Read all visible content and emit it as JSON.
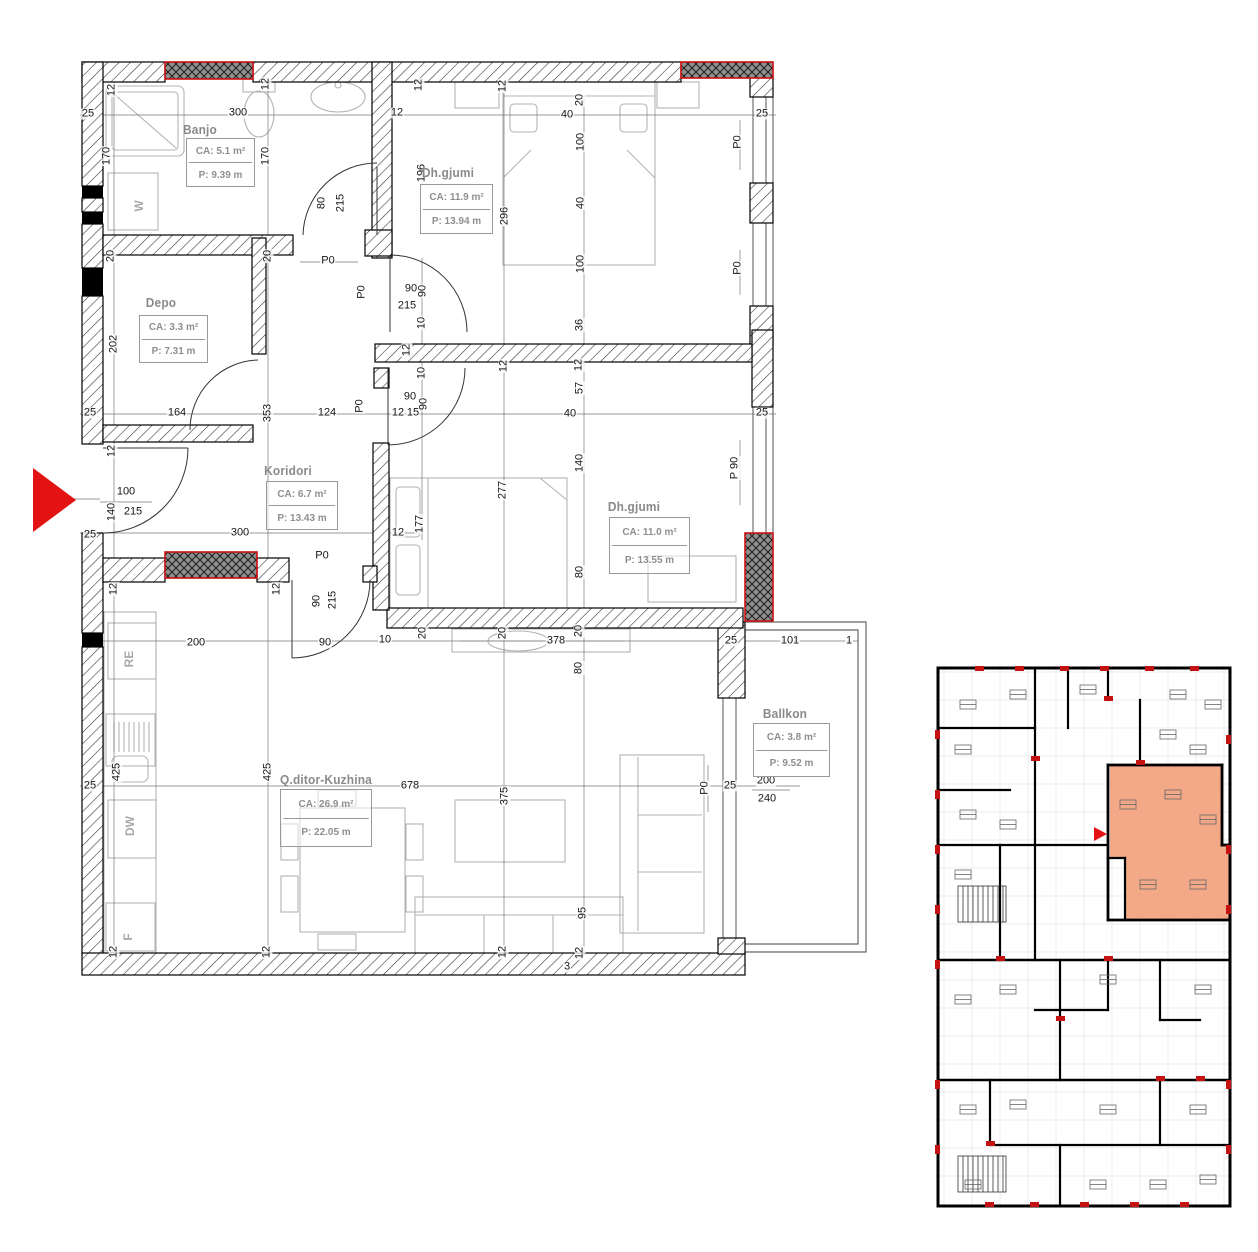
{
  "drawing": {
    "type": "apartment-floor-plan",
    "colors": {
      "wall_line": "#000000",
      "shaft_red": "#cc1111",
      "arrow_red": "#e31313",
      "highlight_orange": "#f2a07b",
      "label_gray": "#8f8f8f",
      "furniture_gray": "#b3b3b3"
    }
  },
  "rooms": [
    {
      "id": "banjo",
      "name": "Banjo",
      "area": "CA:  5.1 m²",
      "perimeter": "P: 9.39 m",
      "name_x": 200,
      "name_y": 130,
      "box_x": 186,
      "box_y": 138,
      "box_w": 67,
      "box_h": 47
    },
    {
      "id": "dhgjumi-1",
      "name": "Dh.gjumi",
      "area": "CA:  11.9 m²",
      "perimeter": "P: 13.94 m",
      "name_x": 448,
      "name_y": 173,
      "box_x": 420,
      "box_y": 184,
      "box_w": 71,
      "box_h": 48
    },
    {
      "id": "depo",
      "name": "Depo",
      "area": "CA: 3.3 m²",
      "perimeter": "P:  7.31 m",
      "name_x": 161,
      "name_y": 303,
      "box_x": 139,
      "box_y": 315,
      "box_w": 67,
      "box_h": 46
    },
    {
      "id": "koridori",
      "name": "Koridori",
      "area": "CA:  6.7 m²",
      "perimeter": "P: 13.43 m",
      "name_x": 288,
      "name_y": 471,
      "box_x": 266,
      "box_y": 481,
      "box_w": 70,
      "box_h": 47
    },
    {
      "id": "dhgjumi-2",
      "name": "Dh.gjumi",
      "area": "CA:  11.0 m²",
      "perimeter": "P: 13.55 m",
      "name_x": 634,
      "name_y": 507,
      "box_x": 609,
      "box_y": 517,
      "box_w": 79,
      "box_h": 55
    },
    {
      "id": "qditor-kuzhina",
      "name": "Q.ditor-Kuzhina",
      "area": "CA:  26.9 m²",
      "perimeter": "P:  22.05 m",
      "name_x": 326,
      "name_y": 780,
      "box_x": 280,
      "box_y": 789,
      "box_w": 90,
      "box_h": 56
    },
    {
      "id": "ballkon",
      "name": "Ballkon",
      "area": "CA: 3.8 m²",
      "perimeter": "P: 9.52 m",
      "name_x": 785,
      "name_y": 714,
      "box_x": 753,
      "box_y": 723,
      "box_w": 75,
      "box_h": 52
    }
  ],
  "appliances": [
    {
      "label": "W",
      "x": 139,
      "y": 206
    },
    {
      "label": "RE",
      "x": 129,
      "y": 659
    },
    {
      "label": "DW",
      "x": 130,
      "y": 826
    },
    {
      "label": "F",
      "x": 128,
      "y": 937
    }
  ],
  "dimensions": [
    {
      "t": "25",
      "x": 88,
      "y": 114,
      "r": 0
    },
    {
      "t": "12",
      "x": 112,
      "y": 90,
      "r": 90
    },
    {
      "t": "170",
      "x": 107,
      "y": 156,
      "r": 90
    },
    {
      "t": "300",
      "x": 238,
      "y": 113,
      "r": 0
    },
    {
      "t": "12",
      "x": 266,
      "y": 84,
      "r": 90
    },
    {
      "t": "170",
      "x": 266,
      "y": 156,
      "r": 90
    },
    {
      "t": "12",
      "x": 397,
      "y": 113,
      "r": 0
    },
    {
      "t": "12",
      "x": 419,
      "y": 85,
      "r": 90
    },
    {
      "t": "12",
      "x": 503,
      "y": 86,
      "r": 90
    },
    {
      "t": "20",
      "x": 580,
      "y": 100,
      "r": 90
    },
    {
      "t": "40",
      "x": 567,
      "y": 115,
      "r": 0
    },
    {
      "t": "100",
      "x": 581,
      "y": 142,
      "r": 90
    },
    {
      "t": "40",
      "x": 581,
      "y": 203,
      "r": 90
    },
    {
      "t": "100",
      "x": 581,
      "y": 264,
      "r": 90
    },
    {
      "t": "36",
      "x": 580,
      "y": 325,
      "r": 90
    },
    {
      "t": "296",
      "x": 505,
      "y": 216,
      "r": 90
    },
    {
      "t": "196",
      "x": 422,
      "y": 173,
      "r": 90
    },
    {
      "t": "25",
      "x": 762,
      "y": 114,
      "r": 0
    },
    {
      "t": "P0",
      "x": 738,
      "y": 142,
      "r": 90
    },
    {
      "t": "P0",
      "x": 738,
      "y": 268,
      "r": 90
    },
    {
      "t": "80",
      "x": 322,
      "y": 203,
      "r": 90
    },
    {
      "t": "215",
      "x": 341,
      "y": 203,
      "r": 90
    },
    {
      "t": "P0",
      "x": 328,
      "y": 261,
      "r": 0
    },
    {
      "t": "20",
      "x": 111,
      "y": 256,
      "r": 90
    },
    {
      "t": "202",
      "x": 114,
      "y": 344,
      "r": 90
    },
    {
      "t": "20",
      "x": 268,
      "y": 256,
      "r": 90
    },
    {
      "t": "25",
      "x": 90,
      "y": 413,
      "r": 0
    },
    {
      "t": "164",
      "x": 177,
      "y": 413,
      "r": 0
    },
    {
      "t": "353",
      "x": 268,
      "y": 413,
      "r": 90
    },
    {
      "t": "124",
      "x": 327,
      "y": 413,
      "r": 0
    },
    {
      "t": "12",
      "x": 112,
      "y": 451,
      "r": 90
    },
    {
      "t": "P0",
      "x": 362,
      "y": 292,
      "r": 90
    },
    {
      "t": "90",
      "x": 411,
      "y": 289,
      "r": 0
    },
    {
      "t": "215",
      "x": 407,
      "y": 306,
      "r": 0
    },
    {
      "t": "90",
      "x": 423,
      "y": 291,
      "r": 90
    },
    {
      "t": "10",
      "x": 422,
      "y": 323,
      "r": 90
    },
    {
      "t": "12",
      "x": 407,
      "y": 350,
      "r": 90
    },
    {
      "t": "10",
      "x": 422,
      "y": 373,
      "r": 90
    },
    {
      "t": "90",
      "x": 410,
      "y": 397,
      "r": 0
    },
    {
      "t": "12",
      "x": 398,
      "y": 413,
      "r": 0
    },
    {
      "t": "15",
      "x": 413,
      "y": 413,
      "r": 0
    },
    {
      "t": "90",
      "x": 424,
      "y": 404,
      "r": 90
    },
    {
      "t": "P0",
      "x": 360,
      "y": 406,
      "r": 90
    },
    {
      "t": "100",
      "x": 126,
      "y": 492,
      "r": 0
    },
    {
      "t": "140",
      "x": 112,
      "y": 512,
      "r": 90
    },
    {
      "t": "215",
      "x": 133,
      "y": 512,
      "r": 0
    },
    {
      "t": "25",
      "x": 90,
      "y": 535,
      "r": 0
    },
    {
      "t": "300",
      "x": 240,
      "y": 533,
      "r": 0
    },
    {
      "t": "12",
      "x": 398,
      "y": 533,
      "r": 0
    },
    {
      "t": "177",
      "x": 420,
      "y": 524,
      "r": 90
    },
    {
      "t": "277",
      "x": 503,
      "y": 490,
      "r": 90
    },
    {
      "t": "12",
      "x": 504,
      "y": 366,
      "r": 90
    },
    {
      "t": "12",
      "x": 579,
      "y": 365,
      "r": 90
    },
    {
      "t": "57",
      "x": 580,
      "y": 388,
      "r": 90
    },
    {
      "t": "40",
      "x": 570,
      "y": 414,
      "r": 0
    },
    {
      "t": "25",
      "x": 762,
      "y": 413,
      "r": 0
    },
    {
      "t": "140",
      "x": 580,
      "y": 463,
      "r": 90
    },
    {
      "t": "80",
      "x": 580,
      "y": 572,
      "r": 90
    },
    {
      "t": "P 90",
      "x": 735,
      "y": 468,
      "r": 90
    },
    {
      "t": "P0",
      "x": 322,
      "y": 556,
      "r": 0
    },
    {
      "t": "90",
      "x": 317,
      "y": 601,
      "r": 90
    },
    {
      "t": "215",
      "x": 333,
      "y": 600,
      "r": 90
    },
    {
      "t": "12",
      "x": 114,
      "y": 589,
      "r": 90
    },
    {
      "t": "12",
      "x": 277,
      "y": 589,
      "r": 90
    },
    {
      "t": "90",
      "x": 325,
      "y": 643,
      "r": 0
    },
    {
      "t": "10",
      "x": 385,
      "y": 640,
      "r": 0
    },
    {
      "t": "20",
      "x": 423,
      "y": 633,
      "r": 90
    },
    {
      "t": "20",
      "x": 503,
      "y": 633,
      "r": 90
    },
    {
      "t": "378",
      "x": 556,
      "y": 641,
      "r": 0
    },
    {
      "t": "20",
      "x": 579,
      "y": 631,
      "r": 90
    },
    {
      "t": "80",
      "x": 579,
      "y": 668,
      "r": 90
    },
    {
      "t": "25",
      "x": 731,
      "y": 641,
      "r": 0
    },
    {
      "t": "101",
      "x": 790,
      "y": 641,
      "r": 0
    },
    {
      "t": "1",
      "x": 849,
      "y": 641,
      "r": 0
    },
    {
      "t": "200",
      "x": 196,
      "y": 643,
      "r": 0
    },
    {
      "t": "425",
      "x": 117,
      "y": 772,
      "r": 90
    },
    {
      "t": "425",
      "x": 268,
      "y": 772,
      "r": 90
    },
    {
      "t": "25",
      "x": 90,
      "y": 786,
      "r": 0
    },
    {
      "t": "678",
      "x": 410,
      "y": 786,
      "r": 0
    },
    {
      "t": "375",
      "x": 505,
      "y": 796,
      "r": 90
    },
    {
      "t": "95",
      "x": 583,
      "y": 913,
      "r": 90
    },
    {
      "t": "12",
      "x": 114,
      "y": 952,
      "r": 90
    },
    {
      "t": "12",
      "x": 267,
      "y": 952,
      "r": 90
    },
    {
      "t": "12",
      "x": 503,
      "y": 952,
      "r": 90
    },
    {
      "t": "12",
      "x": 580,
      "y": 953,
      "r": 90
    },
    {
      "t": "3",
      "x": 567,
      "y": 967,
      "r": 0
    },
    {
      "t": "25",
      "x": 730,
      "y": 786,
      "r": 0
    },
    {
      "t": "200",
      "x": 766,
      "y": 781,
      "r": 0
    },
    {
      "t": "240",
      "x": 767,
      "y": 799,
      "r": 0
    },
    {
      "t": "P0",
      "x": 705,
      "y": 788,
      "r": 90
    }
  ],
  "mini_plan": {
    "highlighted_unit": true,
    "highlight_color": "#f2a07b"
  }
}
